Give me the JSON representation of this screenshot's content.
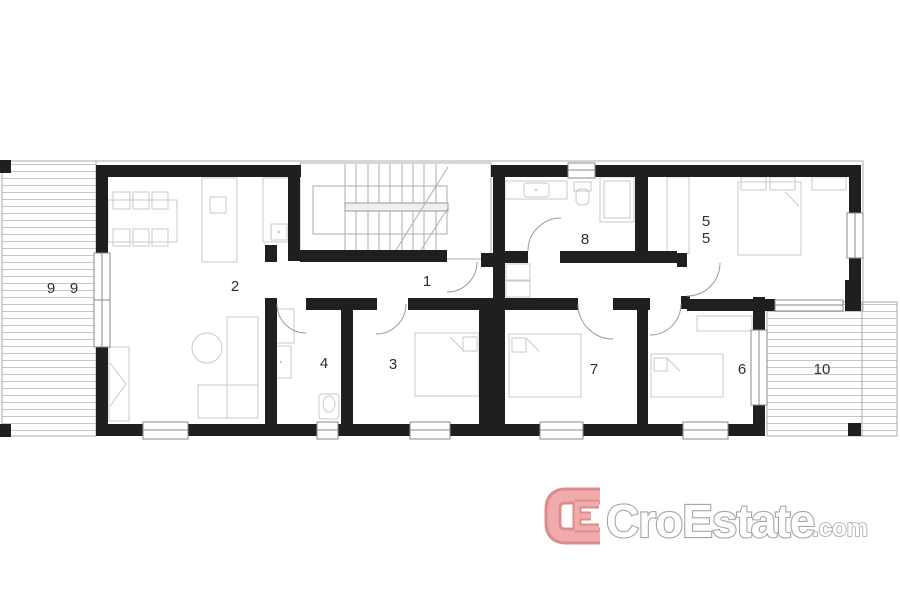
{
  "plan": {
    "type": "floor-plan",
    "rooms": {
      "r1": "1",
      "r2": "2",
      "r3": "3",
      "r4": "4",
      "r5_line1": "5",
      "r5_line2": "5",
      "r6": "6",
      "r7": "7",
      "r8": "8",
      "r9_left": "9",
      "r9_right": "9",
      "r10": "10"
    },
    "colors": {
      "wall": "#1f1f1f",
      "thin_line": "#adadad",
      "furniture_line": "#c9c9c9",
      "hatch_line": "#c6c6c6",
      "label": "#2f2f2f",
      "background": "#ffffff"
    }
  },
  "logo": {
    "brand": "CroEstate",
    "tld": ".com",
    "mark_icon": "ce-monogram",
    "mark_fill": "#f2abab",
    "mark_outline": "#da8d8d",
    "text_outline": "#a5a5a5"
  }
}
